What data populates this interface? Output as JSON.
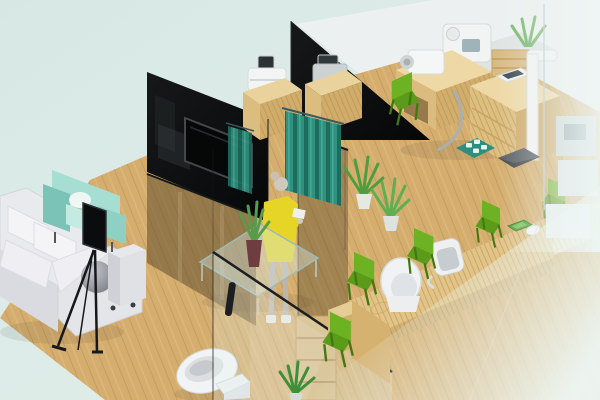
{
  "scene": {
    "description": "Isometric 3D rendering of a clinic interior floor plan",
    "areas": {
      "waiting_area": [
        "white-sectional-sofa",
        "gray-ball-cushion",
        "mint-armchair",
        "glass-coffee-table",
        "aloe-plant-vase",
        "tv-on-easel",
        "gray-side-cabinet"
      ],
      "exam_cubicles": [
        "black-partition-left",
        "wall-tv",
        "black-partition-right",
        "teal-curtain",
        "small-teal-curtain",
        "standing-woman",
        "device-cabinet-a",
        "device-cabinet-b",
        "tinted-glass-walls"
      ],
      "equipment_room": [
        "exam-desk",
        "camera-device",
        "tablet-device",
        "metal-arc",
        "teal-floor-mat",
        "height-scale",
        "scale-platform",
        "green-chair",
        "wood-slat-tower",
        "back-counter",
        "white-machine"
      ],
      "reception": [
        "wooden-reception-desk",
        "white-shell-chair",
        "office-chair",
        "green-visitor-chairs",
        "green-tray",
        "white-mouse",
        "low-wood-step"
      ],
      "restroom": [
        "toilet",
        "storage-shelf",
        "front-glass-pane",
        "glass-door-handle"
      ],
      "plants": [
        "center-plant-pair",
        "bottom-plant",
        "corner-plant"
      ]
    }
  },
  "palette": {
    "bg_top": "#d7e8e4",
    "bg_bottom": "#e4f0ec",
    "floor": "#d5ae6f",
    "plank_line": "#b8925a",
    "plank_light": "#e7cb8e",
    "wall_black_a": "#16181a",
    "wall_black_b": "#060708",
    "frost_wall": "#edf0ef",
    "curtain": "#2f9180",
    "curtain_dark": "#1d6c5c",
    "curtain_light": "#55b09a",
    "tint_glass": "#5f4c28",
    "wood_light": "#eed9a6",
    "wood_mid": "#e2c488",
    "wood_dark": "#d6b271",
    "sofa_white": "#e9eaed",
    "sofa_shadow": "#d9dbe0",
    "mint_chair": "#a7ded3",
    "mint_chair_dark": "#7cc3b7",
    "green_chair": "#6cb222",
    "green_chair_dark": "#5a9c1a",
    "green_leg": "#447712",
    "dress_yellow": "#e6d426",
    "plant_green": "#4f9d3f",
    "device_gray": "#cdd2d3",
    "white_item": "#f2f3f4",
    "fade_white": "#edf7f5"
  }
}
